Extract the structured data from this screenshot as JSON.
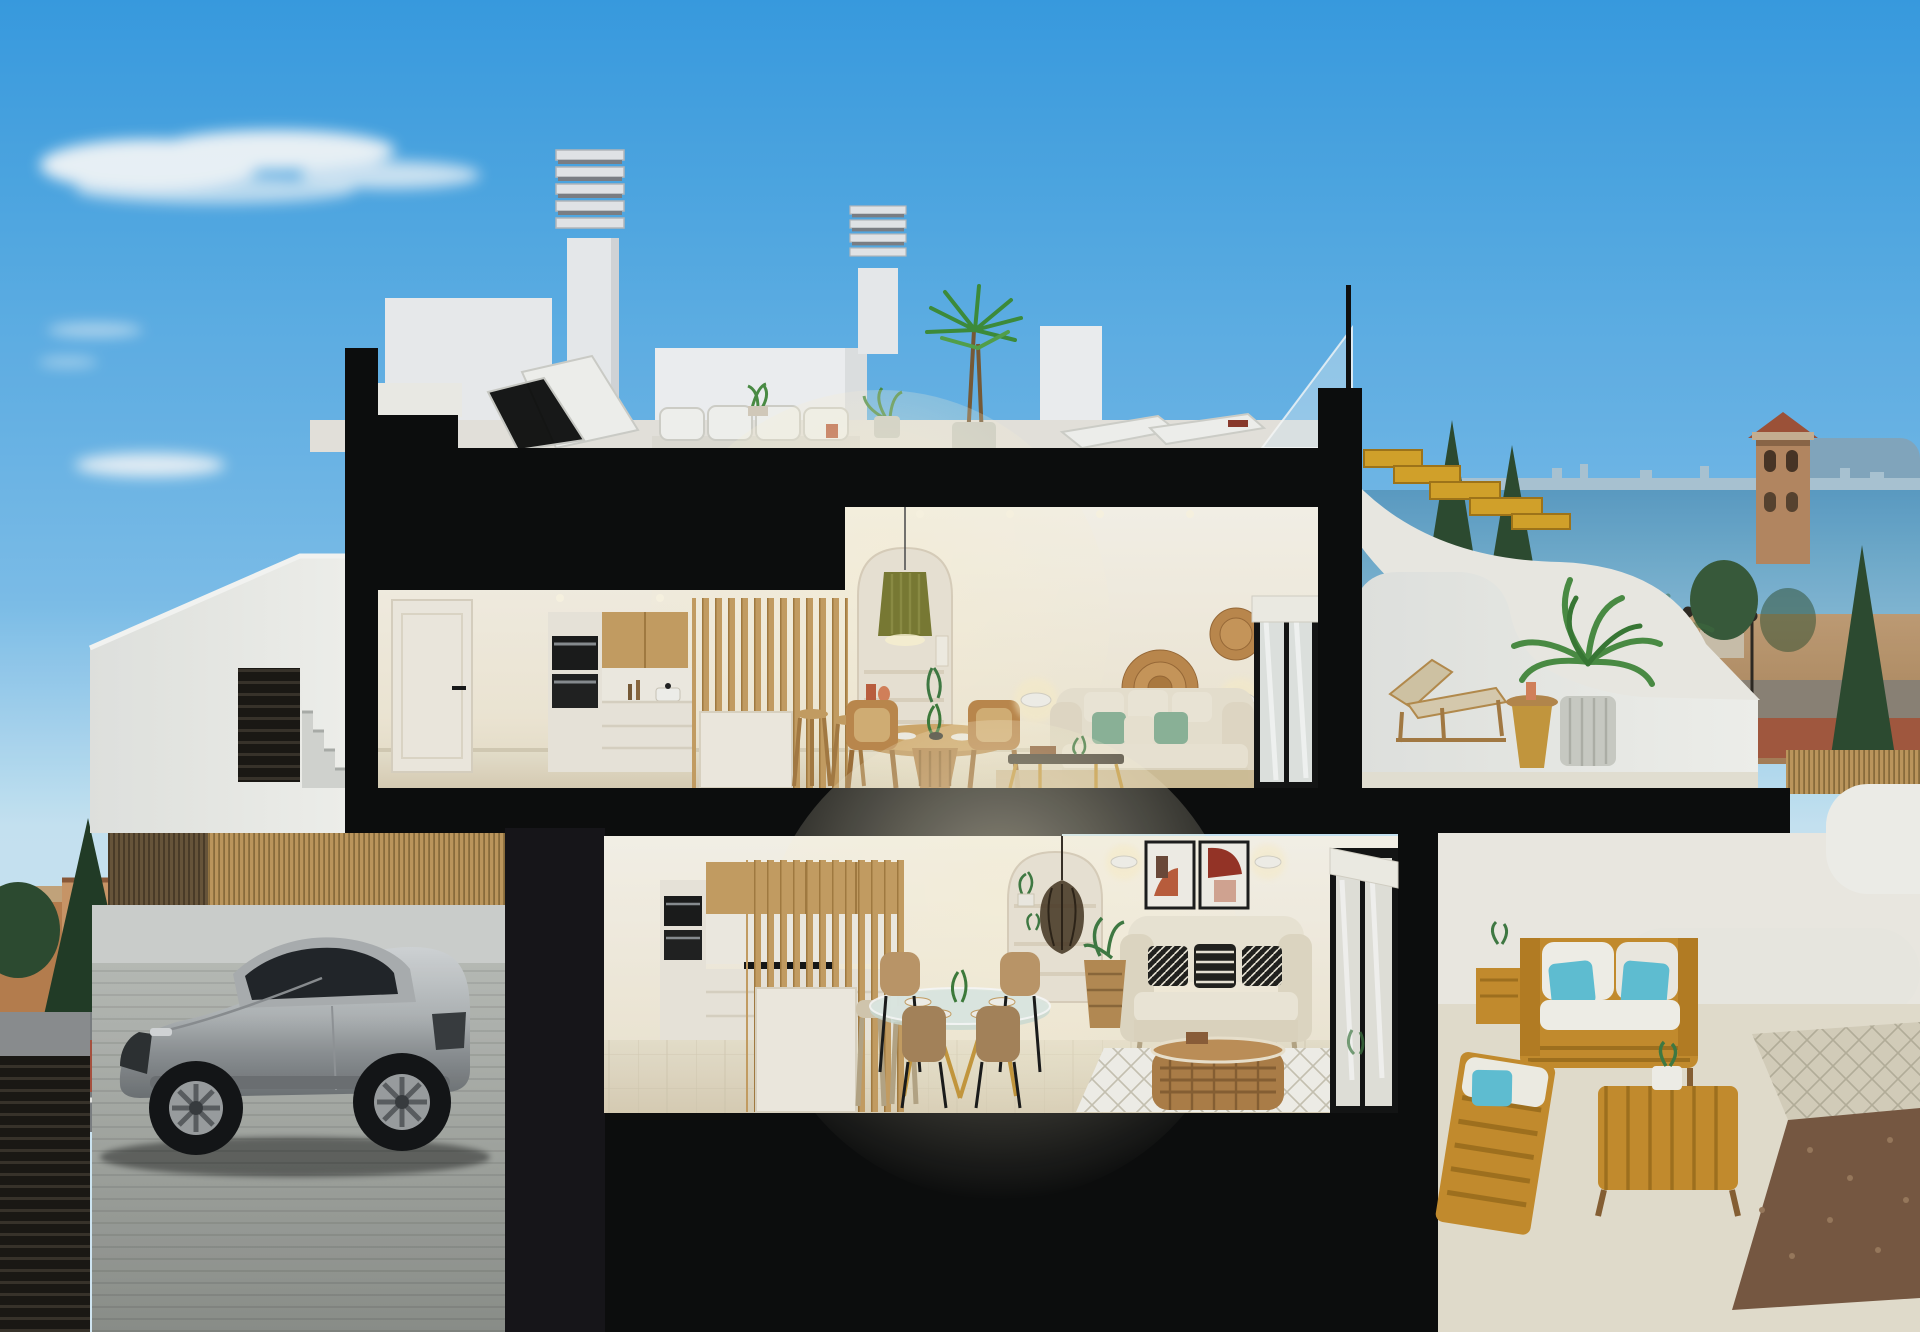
{
  "image": {
    "kind": "architectural-cross-section-3d-render",
    "width_px": 1920,
    "height_px": 1332,
    "description": "Cutaway section render of a two-storey white coastal townhouse with rooftop terrace, upper-floor open kitchen/dining/living, ground-floor kitchen/dining/living, side terraces, street entry stairs, and a semi-basement garage with a silver sports coupe"
  },
  "palette": {
    "skyTop": "#3a9fe5",
    "skyMid": "#7fc2ef",
    "skyLow": "#cbe9f8",
    "cloudWhite": "#ffffff",
    "sectionBlack": "#0d0d0d",
    "wallWhite": "#f2f1ec",
    "wallShade": "#e0e0da",
    "interiorCream": "#f7f1e4",
    "interiorFloor": "#e6dfcc",
    "cabinetWhite": "#efeadf",
    "woodLight": "#c9a164",
    "woodMid": "#b9894f",
    "stairWood": "#d9a62b",
    "sofaCream": "#ede5d4",
    "pillowGreen": "#8fb79c",
    "pillowTeal": "#62c3d8",
    "terracotta": "#c06040",
    "artRed": "#993527",
    "oliveLamp": "#7c7c35",
    "seaBlue": "#6cacd0",
    "skylineGrey": "#aec8d8",
    "mountainBlue": "#86aac2",
    "fieldTan": "#b8936b",
    "dirtRed": "#9c5b3e",
    "treeDark": "#2e4c31",
    "treeMid": "#417c44",
    "townOrange": "#c58b5d",
    "roofTile": "#a2543a",
    "asphaltGrey": "#7e8285",
    "bikeLaneRed": "#ac5340",
    "bambooFence": "#c29b5f",
    "reedDark": "#6b573c",
    "carSilver": "#c0c3c5",
    "gravelBrown": "#7a5a43",
    "rattan": "#9a6a3a",
    "gold": "#c99b3f"
  },
  "scene": {
    "sky": {
      "clouds": [
        "large-wispy-cloud",
        "small-cloud",
        "tiny-cloud-wisps"
      ]
    },
    "background_left": {
      "town": "low orange-roofed houses with dark green trees",
      "street": [
        "grey asphalt",
        "red bike lane",
        "white road markings",
        "round traffic sign"
      ]
    },
    "background_right": {
      "sea": "pale blue sea band with distant city skyline and mountains",
      "watchtower": "tan lookout tower with arched openings and red tiled roof",
      "field": "arid tan field with scattered red-roofed buildings and lamp posts",
      "trees": [
        "dark cypresses",
        "round pines",
        "palms"
      ],
      "fence": "golden reed fence strip"
    },
    "building": {
      "rooftop": {
        "chimneys": [
          "louvered-chimney-large",
          "louvered-chimney-small"
        ],
        "items": [
          "white-outdoor-sofa",
          "sun-loungers",
          "potted-dracaena",
          "potted-plants",
          "glass-balustrade",
          "red-book"
        ]
      },
      "upper_floor": {
        "rooms": [
          "hallway-with-white-door",
          "kitchen",
          "dining-nook",
          "living-room"
        ],
        "items": [
          "built-in-ovens",
          "timber-upper-cabinets",
          "timber-slat-screen",
          "white-island",
          "bar-stools",
          "arched-shelf-niche",
          "olive-pleated-pendant",
          "round-timber-dining-table",
          "wicker-chairs",
          "wall-sconces",
          "wicker-wall-plates",
          "cream-sofa-green-pillows",
          "coffee-table",
          "jute-rug",
          "sliding-glass-door"
        ],
        "terrace": [
          "curved-white-parapet",
          "potted-areca-palm",
          "timber-lounger",
          "mustard-side-table"
        ]
      },
      "exterior_right": [
        "timber-roof-stairs",
        "white-curved-stair-wall"
      ],
      "ground_floor": {
        "rooms": [
          "kitchen",
          "dining-area",
          "living-room"
        ],
        "items": [
          "built-in-ovens",
          "timber-slat-screen",
          "white-island",
          "cream-stools",
          "glass-dining-table",
          "tan-chairs",
          "arched-shelf-niche",
          "rattan-pendant",
          "two-abstract-artworks",
          "wall-sconces",
          "white-loveseat-bw-pillows",
          "basket-plant",
          "rattan-coffee-table",
          "diamond-rug",
          "sliding-glass-door"
        ]
      },
      "entry": [
        "sloped-white-parapet",
        "dark-louvered-gate",
        "concrete-steps"
      ],
      "garage": [
        "reed-privacy-fence",
        "silver-sports-coupe",
        "concrete-driveway",
        "dark-slatted-garage-door"
      ],
      "patio": [
        "white-garden-walls",
        "timber-loveseat-teal-pillows",
        "timber-bench",
        "timber-coffee-table",
        "plant-side-table",
        "diamond-tiled-path",
        "gravel-bed"
      ]
    }
  }
}
